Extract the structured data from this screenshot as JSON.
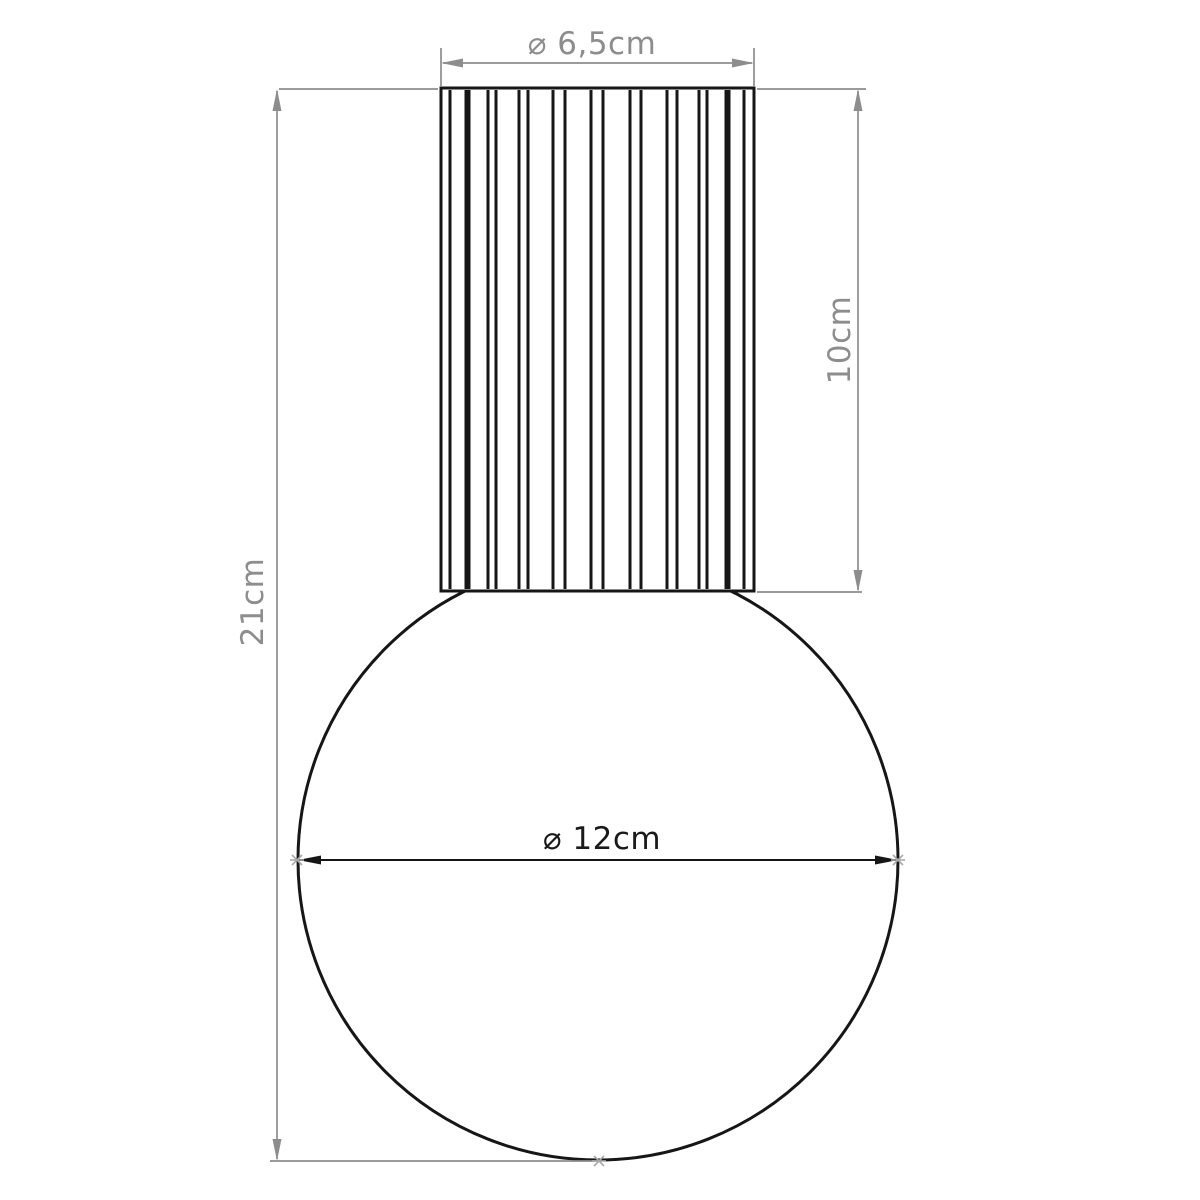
{
  "colors": {
    "line": "#161616",
    "dimension": "#8d8d8d",
    "marker": "#a8a8a8",
    "background": "#ffffff"
  },
  "labels": {
    "cylinder_diameter": "⌀ 6,5cm",
    "cylinder_height": "10cm",
    "total_height": "21cm",
    "sphere_diameter": "⌀ 12cm"
  }
}
